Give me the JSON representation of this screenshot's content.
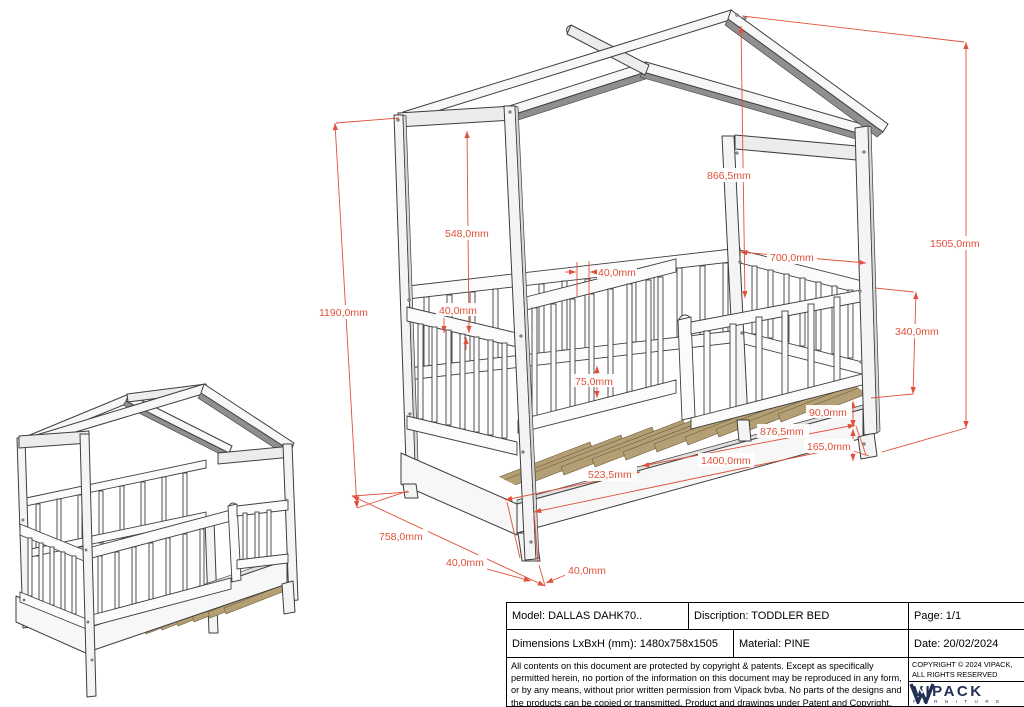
{
  "colors": {
    "dimension_red": "#e0503a",
    "logo_navy": "#232f55",
    "slat_tan": "#b49f74",
    "line_gray": "#3e3e3e"
  },
  "dims": {
    "d1505": "1505,0mm",
    "d866": "866,5mm",
    "d700": "700,0mm",
    "d548": "548,0mm",
    "d1190": "1190,0mm",
    "d40_gap": "40,0mm",
    "d40_rail": "40,0mm",
    "d75": "75,0mm",
    "d340": "340,0mm",
    "d90": "90,0mm",
    "d876": "876,5mm",
    "d165": "165,0mm",
    "d1400": "1400,0mm",
    "d523": "523,5mm",
    "d758": "758,0mm",
    "d40_foot_left": "40,0mm",
    "d40_foot_right": "40,0mm"
  },
  "title_block": {
    "model": "Model: DALLAS DAHK70..",
    "description": "Discription: TODDLER BED",
    "page": "Page: 1/1",
    "dimensions": "Dimensions LxBxH (mm): 1480x758x1505",
    "material": "Material: PINE",
    "date": "Date: 20/02/2024",
    "copyright": "COPYRIGHT  © 2024 VIPACK, ALL RIGHTS RESERVED",
    "legal": "All contents on this document are protected by copyright & patents. Except as specifically permitted herein, no portion of the information on this document may be reproduced in any form, or by any means, without prior written permission from Vipack bvba. No parts of the designs and the products can be copied or transmitted. Product and drawings under Patent and Copyright.",
    "brand": "VIPACK",
    "brand_sub": "F U R N I T U R E"
  }
}
